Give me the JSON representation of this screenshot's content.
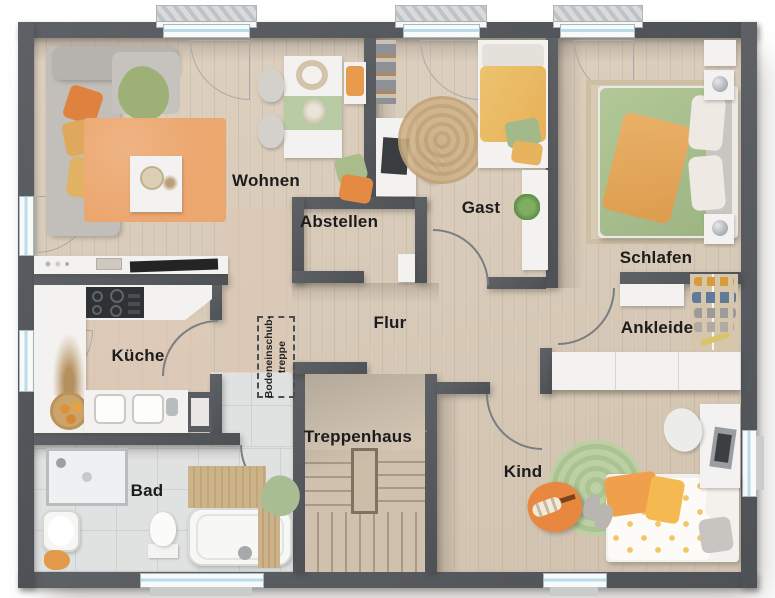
{
  "plan_title": "Obergeschoss Grundriss",
  "rooms": {
    "wohnen": {
      "label": "Wohnen"
    },
    "gast": {
      "label": "Gast"
    },
    "abstellen": {
      "label": "Abstellen"
    },
    "schlafen": {
      "label": "Schlafen"
    },
    "flur": {
      "label": "Flur"
    },
    "ankleide": {
      "label": "Ankleide"
    },
    "kueche": {
      "label": "Küche"
    },
    "treppenhaus": {
      "label": "Treppenhaus"
    },
    "bad": {
      "label": "Bad"
    },
    "kind": {
      "label": "Kind"
    }
  },
  "annotations": {
    "loft_ladder": {
      "line1": "Bodeneinschub-",
      "line2": "treppe"
    }
  },
  "colors": {
    "wall": "#55585c",
    "wood_floor": "#d8cab8",
    "tile_floor": "#e0e2e2",
    "window_glass": "#badbe9",
    "accent_orange": "#e88a42",
    "accent_amber": "#e9b864",
    "accent_green": "#a5bd8b",
    "rug_orange": "#eca76f",
    "rug_green": "#b5c99b",
    "stair_wood": "#cfc1ad"
  }
}
